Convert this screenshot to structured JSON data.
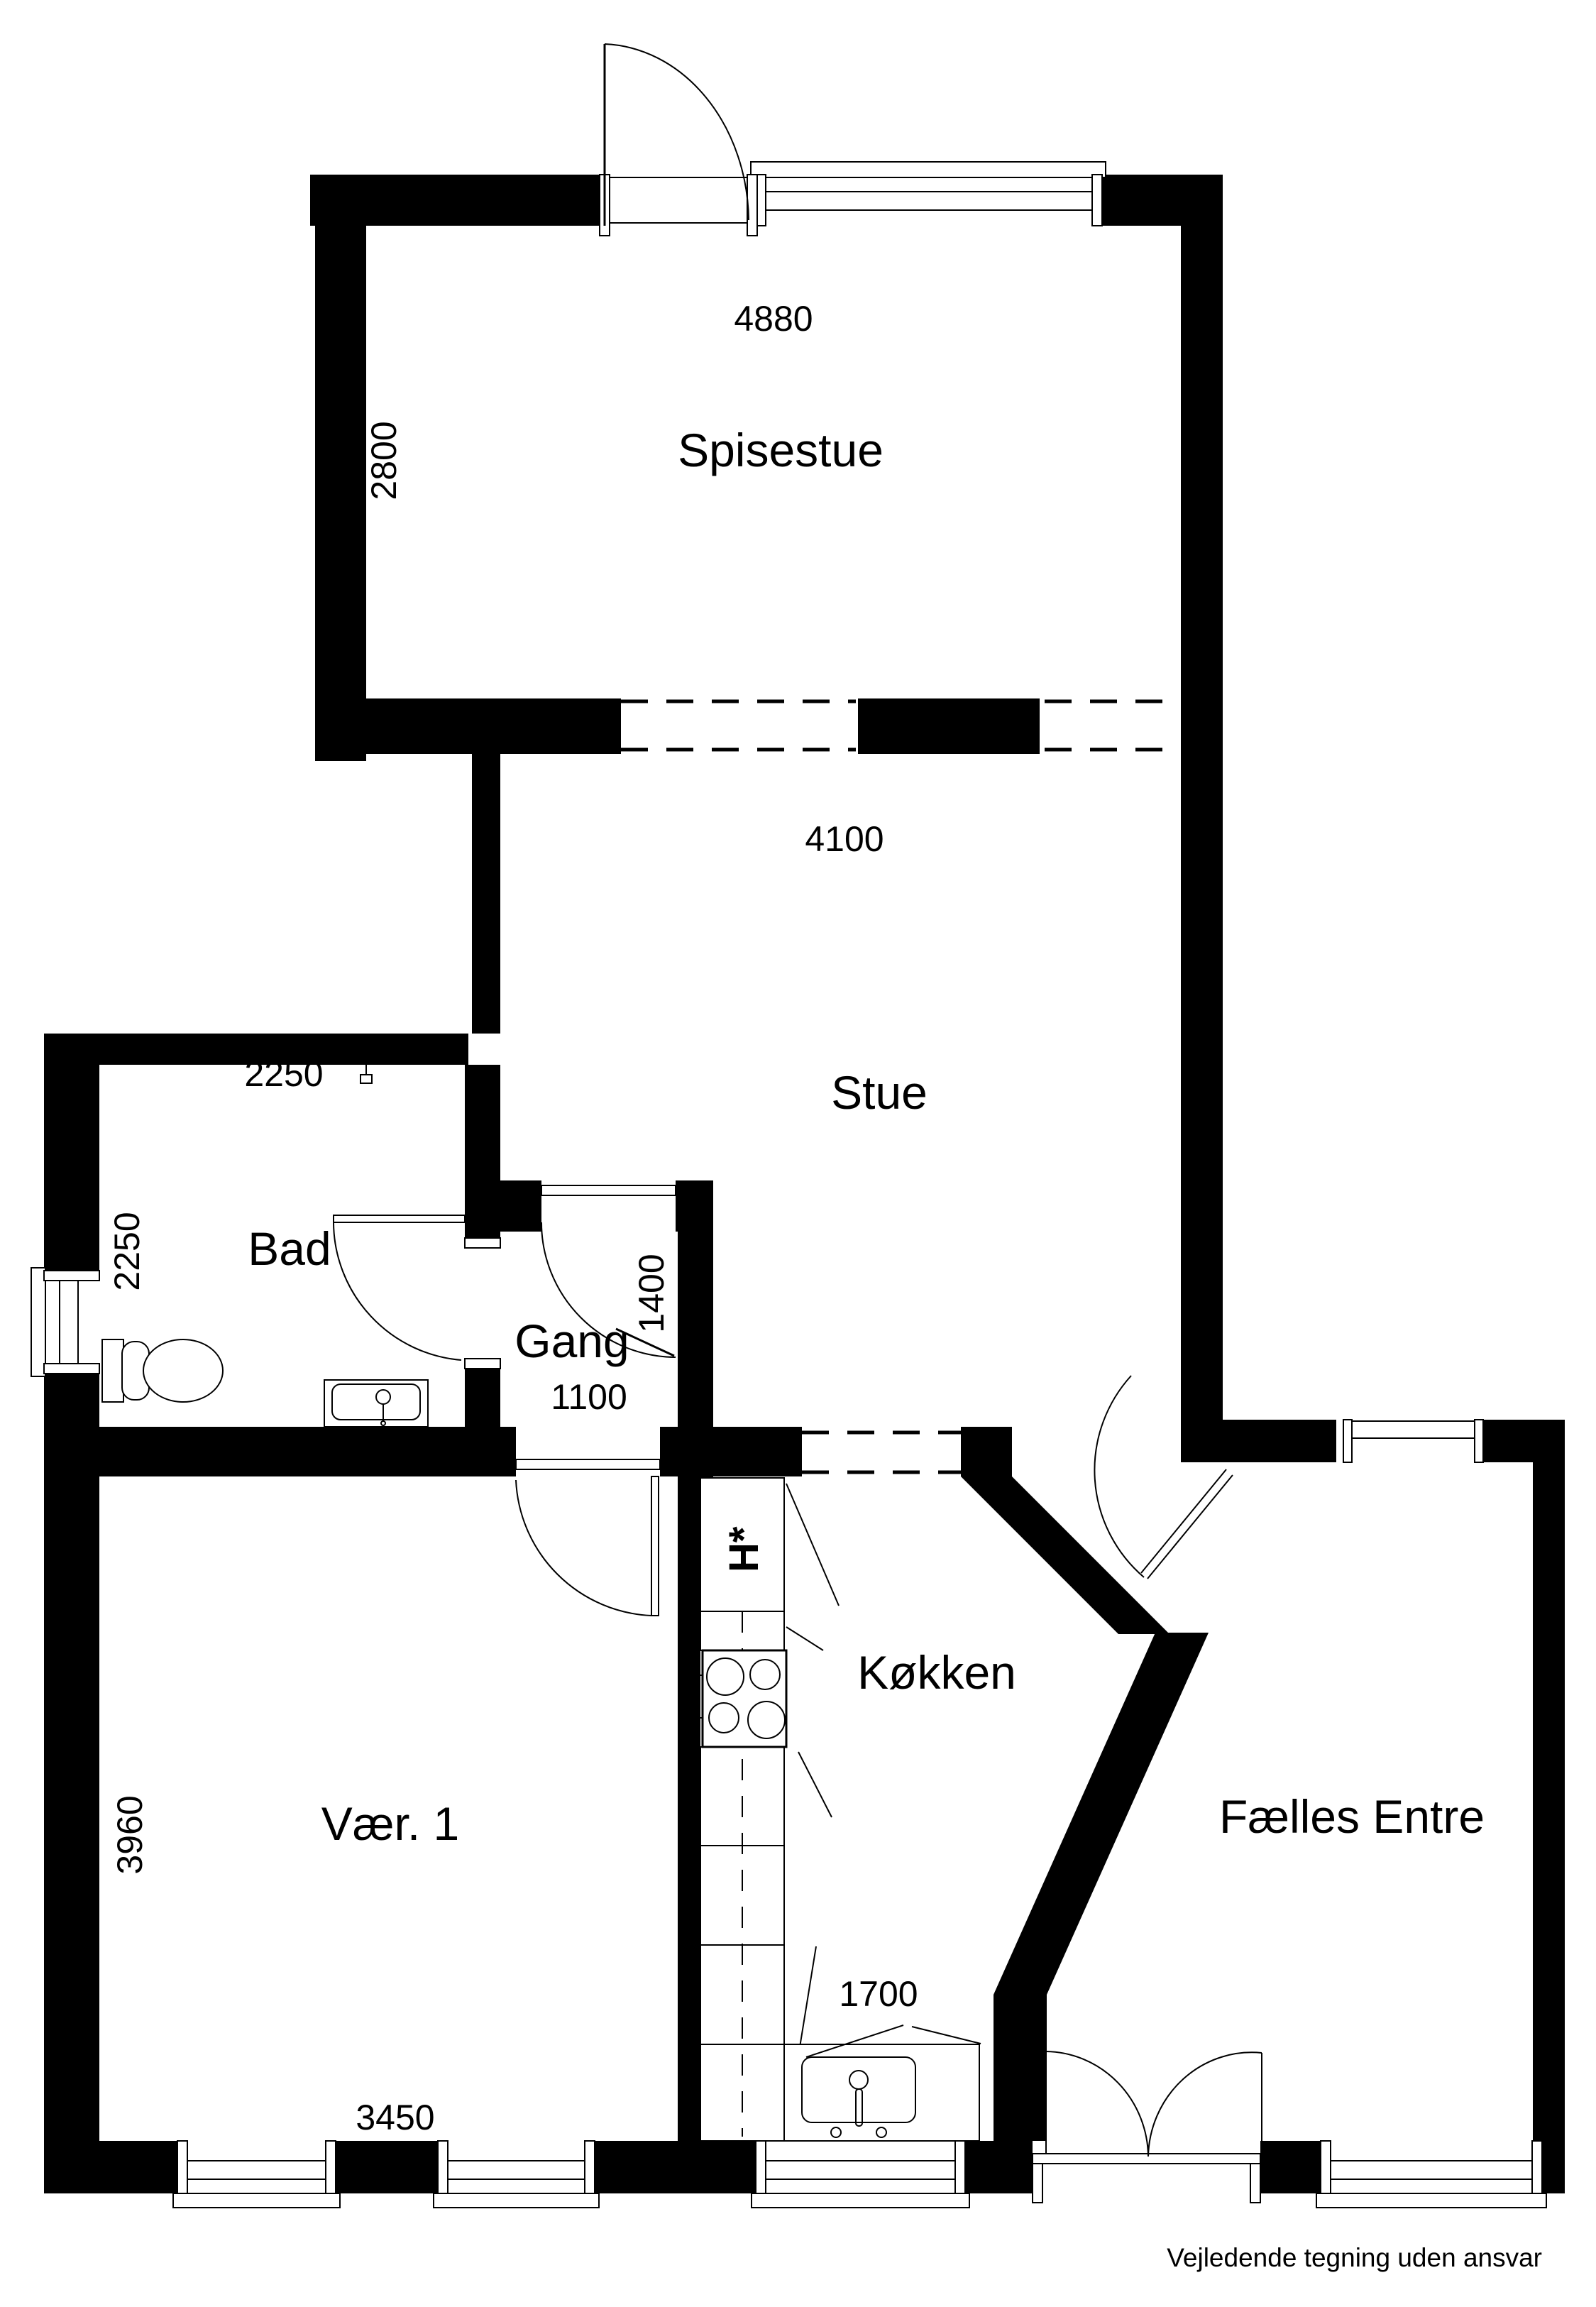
{
  "document": {
    "type": "floor-plan",
    "footer_disclaimer": "Vejledende tegning uden ansvar"
  },
  "colors": {
    "wall": "#000000",
    "background": "#ffffff",
    "line": "#000000"
  },
  "rooms": [
    {
      "id": "spisestue",
      "label": "Spisestue"
    },
    {
      "id": "stue",
      "label": "Stue"
    },
    {
      "id": "bad",
      "label": "Bad"
    },
    {
      "id": "gang",
      "label": "Gang"
    },
    {
      "id": "koekken",
      "label": "Køkken"
    },
    {
      "id": "vaer1",
      "label": "Vær. 1"
    },
    {
      "id": "faelles-entre",
      "label": "Fælles Entre"
    }
  ],
  "dimensions_mm": [
    {
      "id": "dim-4880",
      "value": "4880",
      "room": "spisestue",
      "orientation": "horizontal"
    },
    {
      "id": "dim-2800",
      "value": "2800",
      "room": "spisestue",
      "orientation": "vertical"
    },
    {
      "id": "dim-4100",
      "value": "4100",
      "room": "stue",
      "orientation": "horizontal"
    },
    {
      "id": "dim-2250-h",
      "value": "2250",
      "room": "bad",
      "orientation": "horizontal"
    },
    {
      "id": "dim-2250-v",
      "value": "2250",
      "room": "bad",
      "orientation": "vertical"
    },
    {
      "id": "dim-1400",
      "value": "1400",
      "room": "gang",
      "orientation": "vertical"
    },
    {
      "id": "dim-1100",
      "value": "1100",
      "room": "gang",
      "orientation": "horizontal"
    },
    {
      "id": "dim-3960",
      "value": "3960",
      "room": "vaer1",
      "orientation": "vertical"
    },
    {
      "id": "dim-1700",
      "value": "1700",
      "room": "koekken",
      "orientation": "horizontal"
    },
    {
      "id": "dim-3450",
      "value": "3450",
      "room": "vaer1",
      "orientation": "horizontal"
    }
  ],
  "symbols": {
    "fridge_marker": "H*"
  }
}
